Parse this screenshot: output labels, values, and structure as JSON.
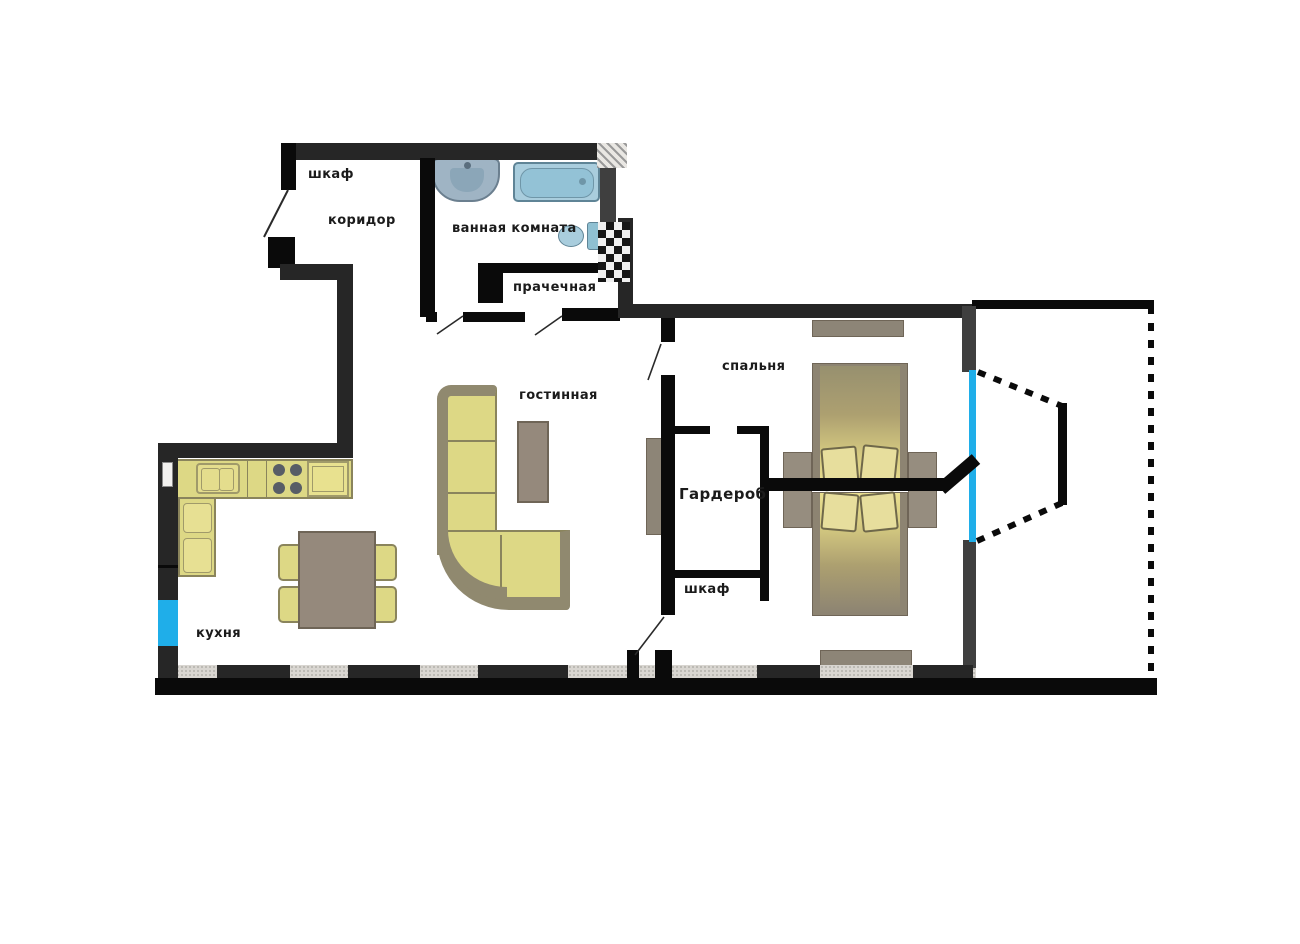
{
  "floor_plan": {
    "type": "apartment-floor-plan",
    "rooms": [
      {
        "id": "entry-closet",
        "label": "шкаф"
      },
      {
        "id": "corridor",
        "label": "коридор"
      },
      {
        "id": "bathroom",
        "label": "ванная комната"
      },
      {
        "id": "laundry",
        "label": "прачечная"
      },
      {
        "id": "living-room",
        "label": "гостинная"
      },
      {
        "id": "bedroom",
        "label": "спальня"
      },
      {
        "id": "wardrobe",
        "label": "Гардероб"
      },
      {
        "id": "closet",
        "label": "шкаф"
      },
      {
        "id": "kitchen",
        "label": "кухня"
      }
    ],
    "colors": {
      "wall_dark": "#262626",
      "wall_black": "#0a0a0a",
      "window_blue": "#1faee9",
      "furniture_yellow": "#ddd885",
      "furniture_olive_edge": "#8a845c",
      "furniture_grey": "#95897c",
      "bed_frame": "#8d8472",
      "fixture_blue": "#a9cddd",
      "texture_light": "#d9d6d1"
    },
    "furniture_icons": [
      "entry-door",
      "bathroom-sink",
      "bathtub",
      "toilet",
      "washer-block",
      "kitchen-counter",
      "kitchen-sink",
      "stove",
      "dining-table",
      "chair",
      "corner-sofa",
      "coffee-table",
      "side-cabinet",
      "bed",
      "nightstand",
      "dresser",
      "balcony-door"
    ]
  }
}
